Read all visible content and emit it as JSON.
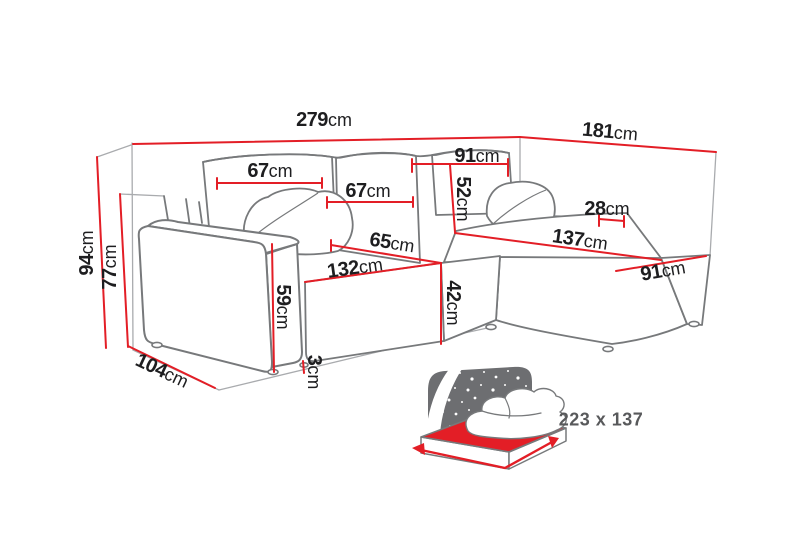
{
  "diagram_type": "corner-sofa-dimension-diagram",
  "dims": {
    "d279": {
      "value": "279",
      "unit": "cm"
    },
    "d181": {
      "value": "181",
      "unit": "cm"
    },
    "d91_back": {
      "value": "91",
      "unit": "cm"
    },
    "d67_left": {
      "value": "67",
      "unit": "cm"
    },
    "d67_mid": {
      "value": "67",
      "unit": "cm"
    },
    "d52": {
      "value": "52",
      "unit": "cm"
    },
    "d28": {
      "value": "28",
      "unit": "cm"
    },
    "d137": {
      "value": "137",
      "unit": "cm"
    },
    "d91_front": {
      "value": "91",
      "unit": "cm"
    },
    "d65": {
      "value": "65",
      "unit": "cm"
    },
    "d132": {
      "value": "132",
      "unit": "cm"
    },
    "d42": {
      "value": "42",
      "unit": "cm"
    },
    "d59": {
      "value": "59",
      "unit": "cm"
    },
    "d3": {
      "value": "3",
      "unit": "cm"
    },
    "d94": {
      "value": "94",
      "unit": "cm"
    },
    "d77": {
      "value": "77",
      "unit": "cm"
    },
    "d104": {
      "value": "104",
      "unit": "cm"
    }
  },
  "sleeping_area": {
    "size": "223 x 137"
  },
  "colors": {
    "dimension_red": "#e31e26",
    "outline_gray": "#77797b",
    "light_gray": "#a9abae",
    "icon_gray": "#6d6e71",
    "text_dark": "#1e1e20",
    "sleeping_text_gray": "#58595b"
  }
}
